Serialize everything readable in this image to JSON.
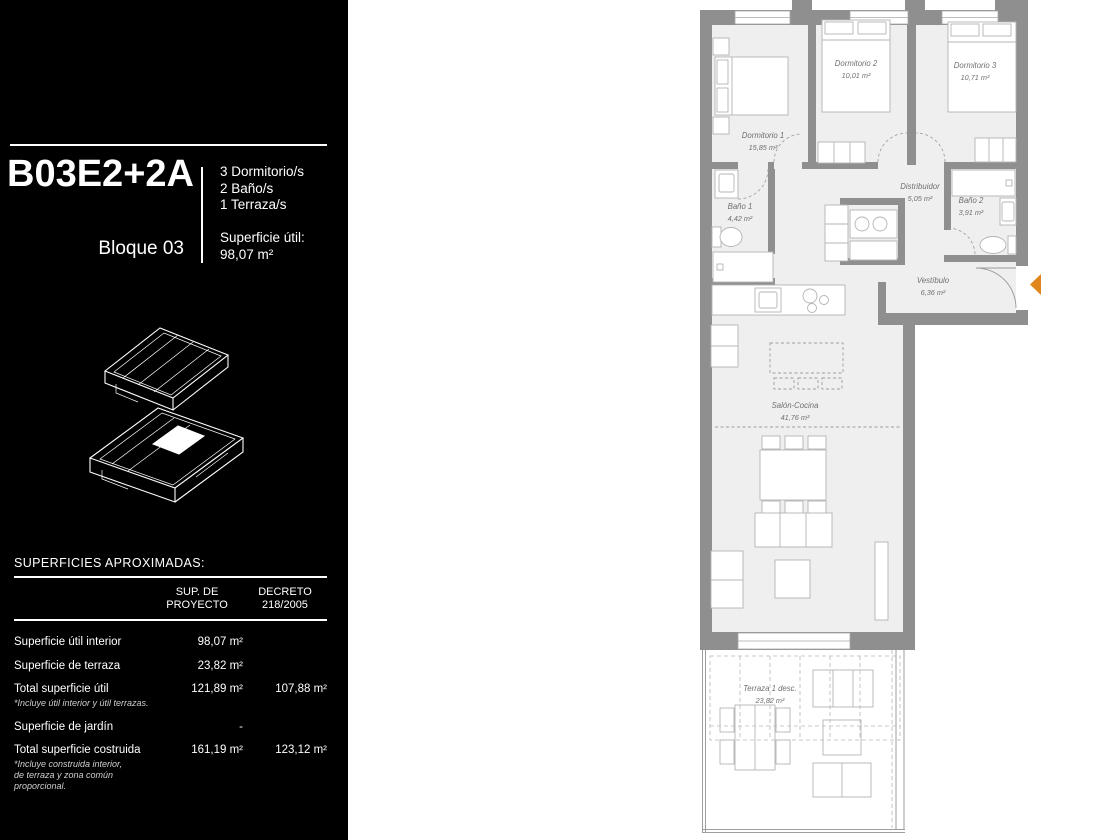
{
  "header": {
    "unit_code": "B03E2+2A",
    "block": "Bloque 03",
    "specs": [
      "3 Dormitorio/s",
      "2 Baño/s",
      "1 Terraza/s"
    ],
    "usable_area_label": "Superficie útil:",
    "usable_area_value": "98,07 m²"
  },
  "surfaces_table": {
    "title": "SUPERFICIES APROXIMADAS:",
    "columns": [
      "SUP. DE\nPROYECTO",
      "DECRETO\n218/2005"
    ],
    "rows": [
      {
        "label": "Superficie útil interior",
        "project": "98,07 m²",
        "decree": ""
      },
      {
        "label": "Superficie de terraza",
        "project": "23,82 m²",
        "decree": ""
      },
      {
        "label": "Total superficie útil",
        "project": "121,89 m²",
        "decree": "107,88 m²",
        "footnote": "*Incluye útil interior y útil terrazas."
      },
      {
        "label": "Superficie de jardín",
        "project": "-",
        "decree": ""
      },
      {
        "label": "Total superficie costruida",
        "project": "161,19 m²",
        "decree": "123,12 m²",
        "footnote": "*Incluye construida interior,\nde terraza y zona común\nproporcional."
      }
    ]
  },
  "plan": {
    "rooms": [
      {
        "name": "Dormitorio 1",
        "area": "15,85 m²"
      },
      {
        "name": "Dormitorio 2",
        "area": "10,01 m²"
      },
      {
        "name": "Dormitorio 3",
        "area": "10,71 m²"
      },
      {
        "name": "Baño 1",
        "area": "4,42 m²"
      },
      {
        "name": "Distribuidor",
        "area": "5,05 m²"
      },
      {
        "name": "Baño 2",
        "area": "3,91 m²"
      },
      {
        "name": "Vestíbulo",
        "area": "6,36 m²"
      },
      {
        "name": "Salón-Cocina",
        "area": "41,76 m²"
      },
      {
        "name": "Terraza 1 desc.",
        "area": "23,82 m²"
      }
    ]
  },
  "colors": {
    "sidebar_bg": "#000000",
    "sidebar_text": "#ffffff",
    "wall": "#8f8f8f",
    "floor": "#efefef",
    "furniture_outline": "#b4b4b4",
    "room_label": "#6f6f6f",
    "entrance_marker": "#e0861c"
  }
}
